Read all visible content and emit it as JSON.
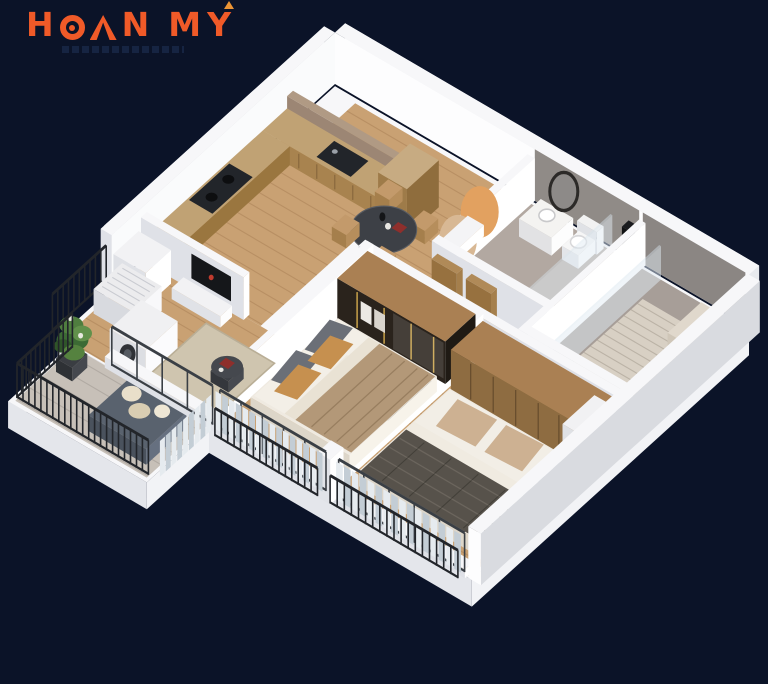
{
  "logo": {
    "text": "HOAN MY",
    "h": "H",
    "n": "N",
    "m": "M",
    "y": "Y",
    "color": "#f05a28",
    "accent_color": "#eb9435"
  },
  "palette": {
    "bg": "#0b1328",
    "wallTop": "#f7f7f9",
    "wallSW": "#dfe1e7",
    "wallSE": "#ffffff",
    "slabSW": "#e4e6eb",
    "slabSE": "#f2f3f6",
    "slabNW": "#d7dade",
    "wood": "#c9a173",
    "counterTop": "#c0a274",
    "counterFace": "#a8834f",
    "applianceDark": "#22252a",
    "marble": "#9c8674",
    "grayWall": "#908b87",
    "tileBath1": "#b2a8a1",
    "tileBath2": "#a79e98",
    "tileBalcony": "#c7c0b8",
    "showerMat": "#d8d0c4",
    "bedBase": "#efeae1",
    "blanketTan": "#b39878",
    "blanketHerringbone": "#57524b",
    "pillowGray": "#6b6f77",
    "pillowOrange": "#c6904f",
    "pillowTan": "#cdb192",
    "wardrobeWood": "#aa8053",
    "wardrobeDark": "#2a231c",
    "gold": "#c9a24a",
    "sofaGray": "#59626e",
    "cushionCream": "#e9dfca",
    "plantGreen": "#3c6a34",
    "plantLight": "#61904b",
    "railingDark": "#22252a",
    "curtainA": "#c3cdd5",
    "curtainB": "#e6ebef",
    "rug": "#cfc5af",
    "wicker": "#c39a6b",
    "tableDark": "#3d4046",
    "decorOrange": "#e2a160",
    "decorTan": "#d8b894",
    "redAccent": "#8e2f2c"
  }
}
